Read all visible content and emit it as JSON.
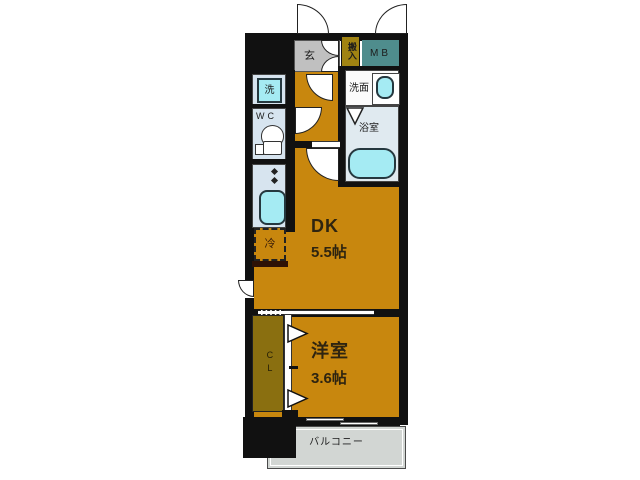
{
  "plan": {
    "genkan_label": "玄",
    "hannyu_label": "搬入",
    "mb_label": "MB",
    "laundry_label": "洗",
    "wc_label": "WC",
    "washroom_label": "洗面",
    "bathroom_label": "浴室",
    "dk_label": "DK",
    "dk_size": "5.5帖",
    "fridge_label": "冷",
    "closet_label": "CL",
    "western_label": "洋室",
    "western_size": "3.6帖",
    "balcony_label": "バルコニー"
  },
  "colors": {
    "room_orange": "#c8870e",
    "closet_olive": "#8a6f10",
    "hannyu_olive": "#a08312",
    "mb_teal": "#4f8d8d",
    "genkan_gray": "#c0c0c0",
    "wet_room_blue": "#d7e4ef",
    "bath_blue": "#e0eaf0",
    "fixture_cyan": "#a5ebf3",
    "balcony_gray": "#d2d6d3",
    "wall_black": "#111111"
  }
}
